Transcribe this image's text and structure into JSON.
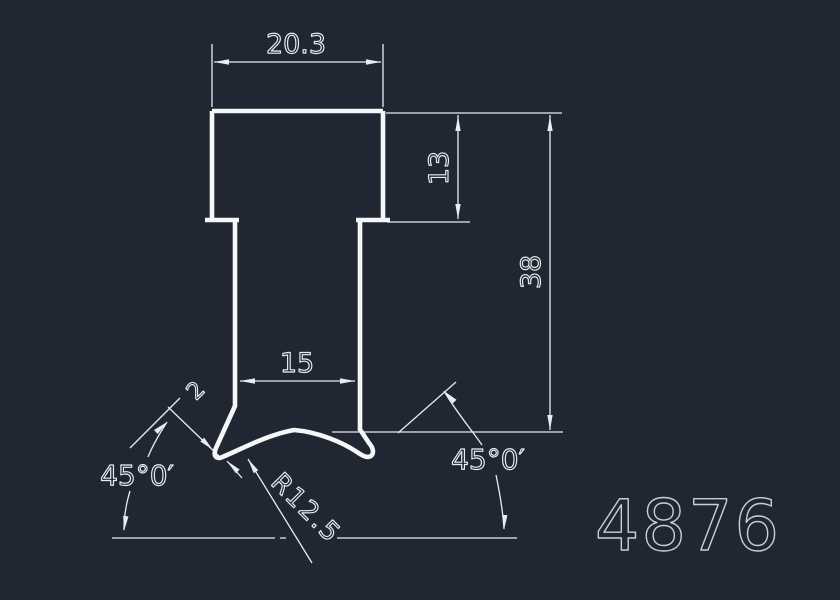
{
  "colors": {
    "background": "#212732",
    "line": "#f4f6f7",
    "dim": "#e9ecee",
    "part_number": "#c9ced4"
  },
  "profile": {
    "part_number": "4876"
  },
  "dimensions": {
    "top_width": "20.3",
    "head_height": "13",
    "overall_height": "38",
    "stem_width": "15",
    "left_angle": "45°0′",
    "right_angle": "45°0′",
    "leg_thickness": "2",
    "radius": "R12.5"
  }
}
